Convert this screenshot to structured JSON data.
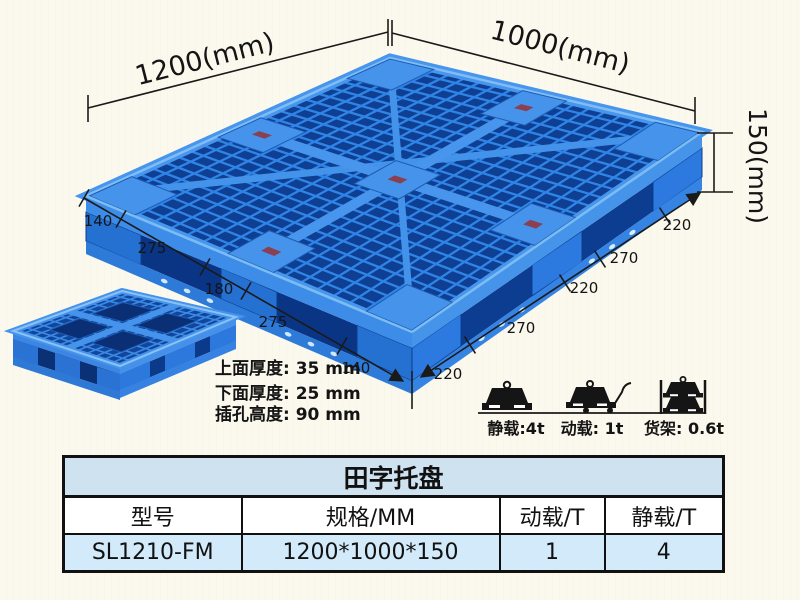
{
  "diagram": {
    "dim_length": "1200(mm)",
    "dim_width": "1000(mm)",
    "dim_height": "150(mm)",
    "left_chain": [
      "140",
      "275",
      "180",
      "275",
      "140"
    ],
    "right_chain": [
      "220",
      "270",
      "220",
      "270",
      "220"
    ],
    "notes": [
      "上面厚度: 35 mm",
      "下面厚度: 25 mm",
      "插孔高度: 90 mm"
    ],
    "loads": [
      {
        "icon": "static-load-icon",
        "label": "静载:4t"
      },
      {
        "icon": "dynamic-load-icon",
        "label": "动载: 1t"
      },
      {
        "icon": "rack-load-icon",
        "label": "货架: 0.6t"
      }
    ]
  },
  "table": {
    "title": "田字托盘",
    "headers": [
      "型号",
      "规格/MM",
      "动载/T",
      "静载/T"
    ],
    "row": [
      "SL1210-FM",
      "1200*1000*150",
      "1",
      "4"
    ]
  },
  "colors": {
    "pallet_blue": "#2f84e6",
    "pallet_dark": "#0e3f92",
    "line_black": "#1a1a1a",
    "table_title_bg": "#cfe2f0",
    "table_row_bg": "#d2eaf9",
    "background": "#fbf9ee"
  }
}
